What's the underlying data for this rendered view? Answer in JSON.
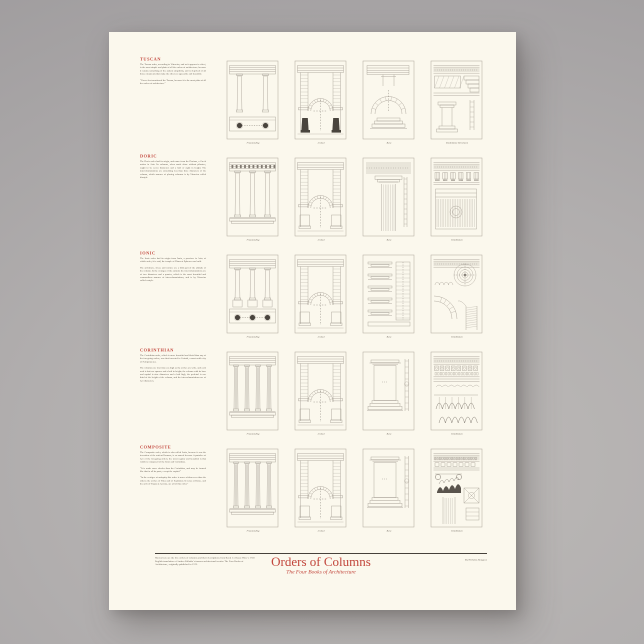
{
  "colors": {
    "accent": "#c2463c",
    "paper": "#fbf8ed",
    "backdrop": "#aba8a8",
    "ink": "#6b6359"
  },
  "footer": {
    "title": "Orders of Columns",
    "subtitle": "The Four Books of Architecture",
    "byline": "By Nicholas Rougeux",
    "note": "Shown here are the five orders of columns and their descriptions from Book 1 of Isaac Ware’s 1738 English translation of Andrea Palladio’s famous architectural treatise The Four Books of Architecture, originally published in 1570."
  },
  "sections": [
    {
      "name": "TUSCAN",
      "paragraphs": [
        "The Tuscan order, according to Vitruvius, and as it appears in effect, is the most simple and plain of all the orders of architecture; because it retains something of the antient simplicity, and is deprived of all those ornaments that make the others so agreeable and beautiful.",
        "“I have first mentioned the Tuscan, because it is the most plain of all the orders of architecture.”"
      ],
      "labels": [
        "Freestanding",
        "Arched",
        "Base",
        "Entablature & Column"
      ]
    },
    {
      "name": "DORIC",
      "paragraphs": [
        "The Doric order had its origin, and name from the Dorians, a Greek nation in Asia. Its columns, when made alone without pilasters, ought to be seven diameters and a half or eight in height. The intercolumniations are something less than three diameters of the column, which manner of placing columns is by Vitruvius called diastyle."
      ],
      "labels": [
        "Freestanding",
        "Arched",
        "Base",
        "Entablature"
      ]
    },
    {
      "name": "IONIC",
      "paragraphs": [
        "The Ionic order had its origin from Ionia, a province in Asia; of which order, it is said, the temple of Diana at Ephesus was built.",
        "The architrave, frieze and cornice are a fifth part of the altitude of the column. In the vestiges of the antients the intercolumniations are of two diameters and a quarter, which is the most beautiful and commodious manner of intercolumniations, and is by Vitruvius called eustyle."
      ],
      "labels": [
        "Freestanding",
        "Arched",
        "Base",
        "Entablature"
      ]
    },
    {
      "name": "CORINTHIAN",
      "paragraphs": [
        "The Corinthian order, which is more beautiful and florid than any of the foregoing orders, was first invented in Corinth, a most noble city of Peloponnesus.",
        "The columns are four times as high as the arches are wide, and each arch is but two squares and a half in height; the column with its base and capital is nine diameters and a half high, the pedestal is one third of the height of the column, and the intercolumniations are of two diameters."
      ],
      "labels": [
        "Freestanding",
        "Arched",
        "Base",
        "Entablature"
      ]
    },
    {
      "name": "COMPOSITE",
      "paragraphs": [
        "The Composite order, which is also called Latin, because it was the invention of the antient Romans, is so named because it partakes of two of the foregoing orders; the most regular and beautiful is that which is composed of the Ionic and Corinthian.",
        "“It is made more slender than the Corinthian, and may be formed like that in all its parts, except the capital.”",
        "“In the vestiges of antiquity this order is more seldom seen than the others; the arches of Titus and of Septimius Severus at Rome, and the arch of Trajan at Ancona, are all of this order.”"
      ],
      "labels": [
        "Freestanding",
        "Arched",
        "Base",
        "Entablature"
      ]
    }
  ]
}
